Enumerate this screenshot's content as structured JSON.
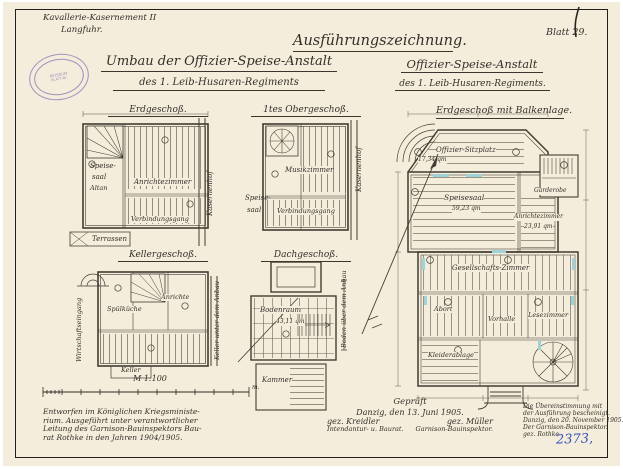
{
  "page": {
    "corner_note": [
      "Kavallerie-Kasernement II",
      "Langfuhr."
    ],
    "drawing_type": "Ausführungszeichnung.",
    "sheet_label": "Blatt 29.",
    "title_left": [
      "Umbau der Offizier-Speise-Anstalt",
      "des 1. Leib-Husaren-Regiments"
    ],
    "title_right": [
      "Offizier-Speise-Anstalt",
      "des 1. Leib-Husaren-Regiments."
    ],
    "stamp": [
      "MUSEUM",
      "BLATT-Nr."
    ],
    "archive_number": "2373,"
  },
  "plans": {
    "eg": {
      "title": "Erdgeschoß.",
      "speise": "Speise-",
      "saal": "saal",
      "altan": "Altan",
      "anrichtezimmer": "Anrichtezimmer",
      "verbindungsgang": "Verbindungsgang",
      "terrassen": "Terrassen",
      "side": "Kasernenhof"
    },
    "og": {
      "title": "1tes Obergeschoß.",
      "speise": "Speise-",
      "saal": "saal",
      "musikzimmer": "Musikzimmer",
      "verbindungsgang": "Verbindungsgang",
      "side": "Kasernenhof"
    },
    "kg": {
      "title": "Kellergeschoß.",
      "spuelkueche": "Spülküche",
      "anrichte": "Anrichte",
      "keller": "Keller",
      "side_left": "Wirtschaftseingang",
      "side_right": "Keller unter dem Anbau"
    },
    "dg": {
      "title": "Dachgeschoß.",
      "bodenraum": "Bodenraum",
      "bodenraum_area": "43,11 qm",
      "kammer": "Kammer",
      "side": "Boden über dem Anbau"
    },
    "main": {
      "title": "Erdgeschoß mit Balkenlage.",
      "sitzplatz": "Offizier-Sitzplatz",
      "sitzplatz_area": "17,34 qm",
      "speisesaal": "Speisesaal",
      "speisesaal_area": "59,23 qm",
      "anrichtezimmer": "Anrichtezimmer",
      "anrichtezimmer_area": "23,91 qm",
      "garderobe": "Garderobe",
      "gesellschaftszimmer": "Gesellschafts-Zimmer",
      "abort": "Abort",
      "vorhalle": "Vorhalle",
      "lesezimmer": "Lesezimmer",
      "kleiderablage": "Kleiderablage"
    }
  },
  "scale": {
    "label": "M 1:100",
    "unit": "m."
  },
  "footer": {
    "note": [
      "Entworfen im Königlichen Kriegsministe-",
      "rium. Ausgeführt unter verantwortlicher",
      "Leitung des Garnison-Bauinspektors Bau-",
      "rat Rothke in den Jahren 1904/1905."
    ],
    "check": {
      "title": "Geprüft",
      "date": "Danzig, den 13. Juni 1905.",
      "sig_left": "gez. Kreidler",
      "sig_right": "gez. Müller",
      "role_left": "Intendantur- u. Baurat.",
      "role_right": "Garnison-Bauinspektor."
    },
    "cert": [
      "Die Übereinstimmung mit",
      "der Ausführung bescheinigt.",
      "Danzig, den 20. November 1905.",
      "Der Garnison-Bauinspektor.",
      "gez. Rothke."
    ]
  }
}
